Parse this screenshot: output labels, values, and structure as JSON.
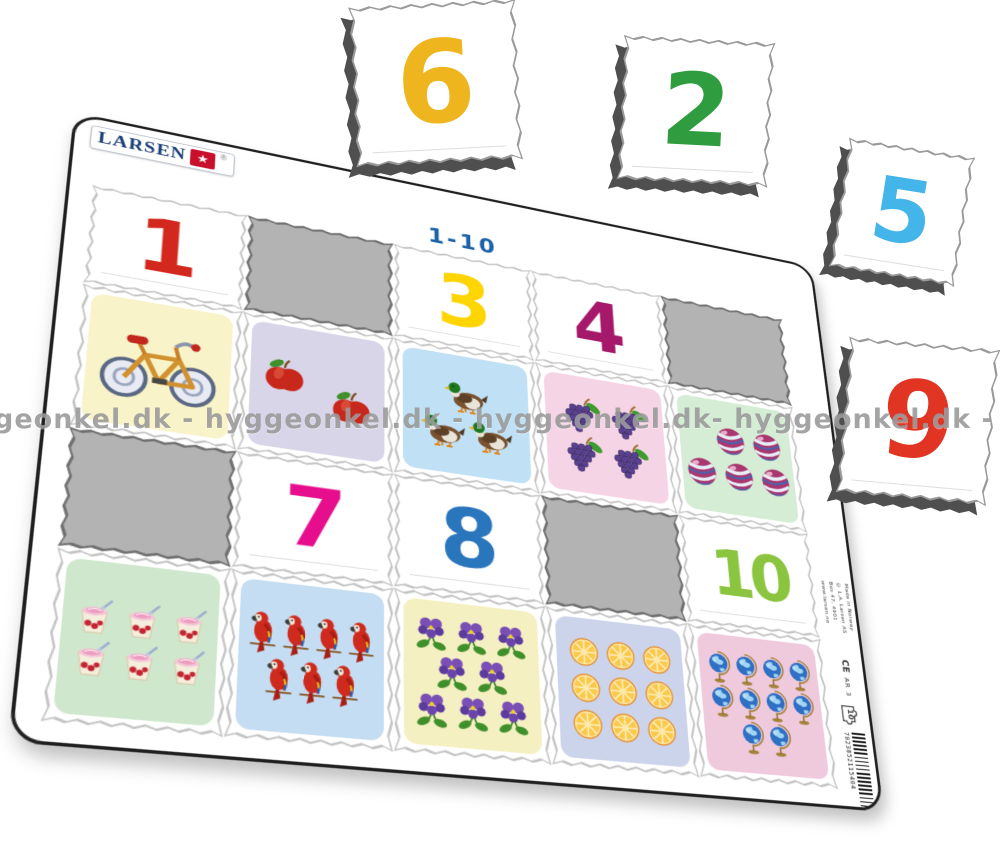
{
  "watermark": "geonkel.dk - hyggeonkel.dk - hyggeonkel.dk- hyggeonkel.dk - hyggeonkel.dk - h",
  "logo": {
    "text": "LARSEN",
    "star": "★",
    "registered": "®"
  },
  "board": {
    "title": "1-10",
    "rows": [
      {
        "type": "numbers",
        "cells": [
          {
            "kind": "number",
            "value": "1",
            "color": "#d3281d"
          },
          {
            "kind": "slot"
          },
          {
            "kind": "number",
            "value": "3",
            "color": "#fed500"
          },
          {
            "kind": "number",
            "value": "4",
            "color": "#a6186a"
          },
          {
            "kind": "slot"
          }
        ]
      },
      {
        "type": "pictures",
        "cells": [
          {
            "kind": "picture",
            "item": "bicycle",
            "count": 1,
            "bg": "#f8f3c8"
          },
          {
            "kind": "picture",
            "item": "apple",
            "count": 2,
            "bg": "#d8d5e8"
          },
          {
            "kind": "picture",
            "item": "duck",
            "count": 3,
            "bg": "#bfe0f5"
          },
          {
            "kind": "picture",
            "item": "grapes",
            "count": 4,
            "bg": "#f5d5e5"
          },
          {
            "kind": "picture",
            "item": "ball",
            "count": 5,
            "bg": "#d5ecd5"
          }
        ]
      },
      {
        "type": "numbers",
        "cells": [
          {
            "kind": "slot"
          },
          {
            "kind": "number",
            "value": "7",
            "color": "#e60e8c"
          },
          {
            "kind": "number",
            "value": "8",
            "color": "#2a76bd"
          },
          {
            "kind": "slot"
          },
          {
            "kind": "number",
            "value": "10",
            "color": "#8bc53f"
          }
        ]
      },
      {
        "type": "pictures",
        "cells": [
          {
            "kind": "picture",
            "item": "yogurt",
            "count": 6,
            "bg": "#cfe7cc"
          },
          {
            "kind": "picture",
            "item": "parrot",
            "count": 7,
            "bg": "#c5ddf2"
          },
          {
            "kind": "picture",
            "item": "violet",
            "count": 8,
            "bg": "#f5f0c2"
          },
          {
            "kind": "picture",
            "item": "orange",
            "count": 9,
            "bg": "#ccd4ec"
          },
          {
            "kind": "picture",
            "item": "globe",
            "count": 10,
            "bg": "#efcadd"
          }
        ]
      }
    ],
    "side": {
      "credits": [
        "Made in Norway",
        "© L.A. Larsen AS",
        "Box 47, 4901",
        "www.larsen.no"
      ],
      "ce": "CE",
      "code": "AR 3",
      "piece_count": "10",
      "barcode_digits": "7023852115404"
    }
  },
  "loose_pieces": [
    {
      "value": "6",
      "color": "#efb51f"
    },
    {
      "value": "2",
      "color": "#2f9d3f"
    },
    {
      "value": "5",
      "color": "#44b5e9"
    },
    {
      "value": "9",
      "color": "#e13422"
    }
  ],
  "colors": {
    "board_outline": "#1f1f1f",
    "slot_face": "#b3b3b3",
    "title_blue": "#1c63a8",
    "logo_red": "#c8102e",
    "logo_blue": "#1c3e76"
  }
}
